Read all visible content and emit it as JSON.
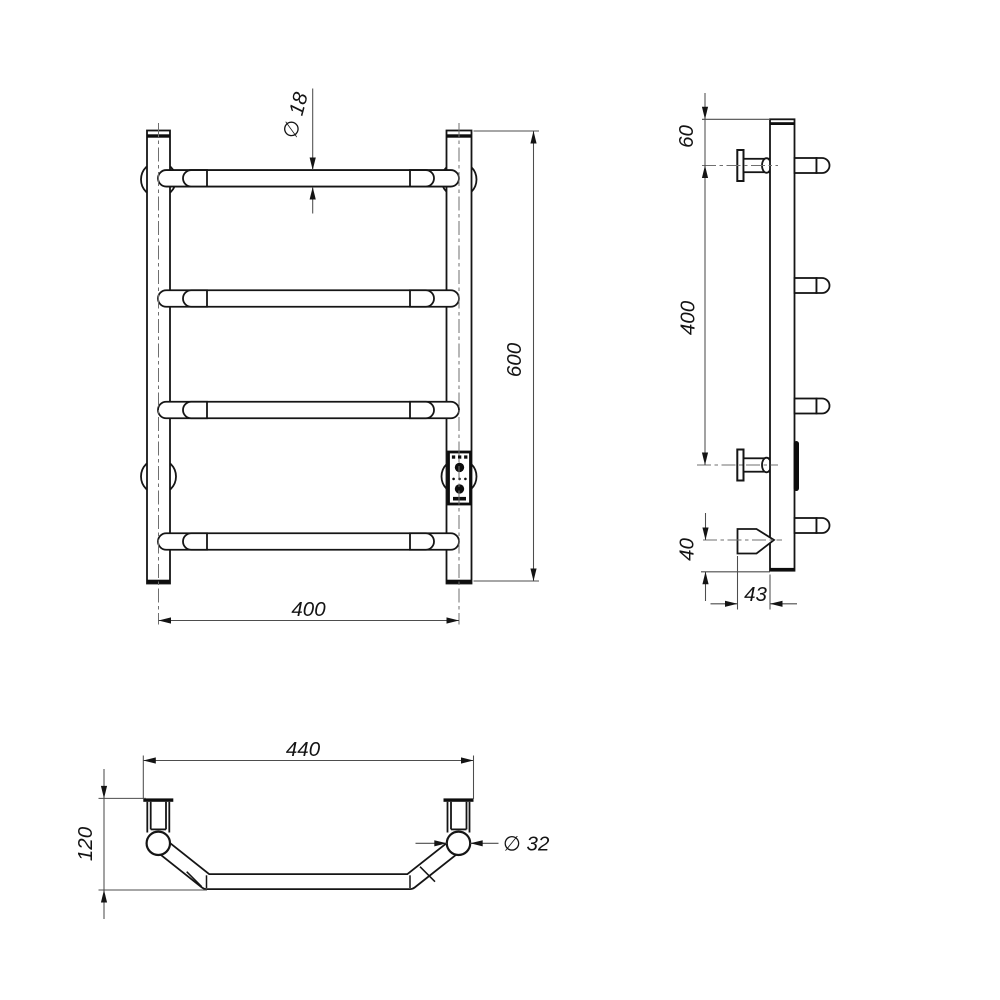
{
  "colors": {
    "line": "#151515",
    "thin_line": "#4d4d4d",
    "background": "#ffffff"
  },
  "front_view": {
    "dim_rung_diameter": "∅ 18",
    "dim_height": "600",
    "dim_rail_spacing": "400"
  },
  "side_view": {
    "dim_top_to_bracket": "60",
    "dim_bracket_spacing": "400",
    "dim_bottom_offset": "40",
    "dim_wall_depth": "43"
  },
  "bottom_view": {
    "dim_overall_width": "440",
    "dim_depth": "120",
    "dim_post_diameter": "∅ 32"
  }
}
